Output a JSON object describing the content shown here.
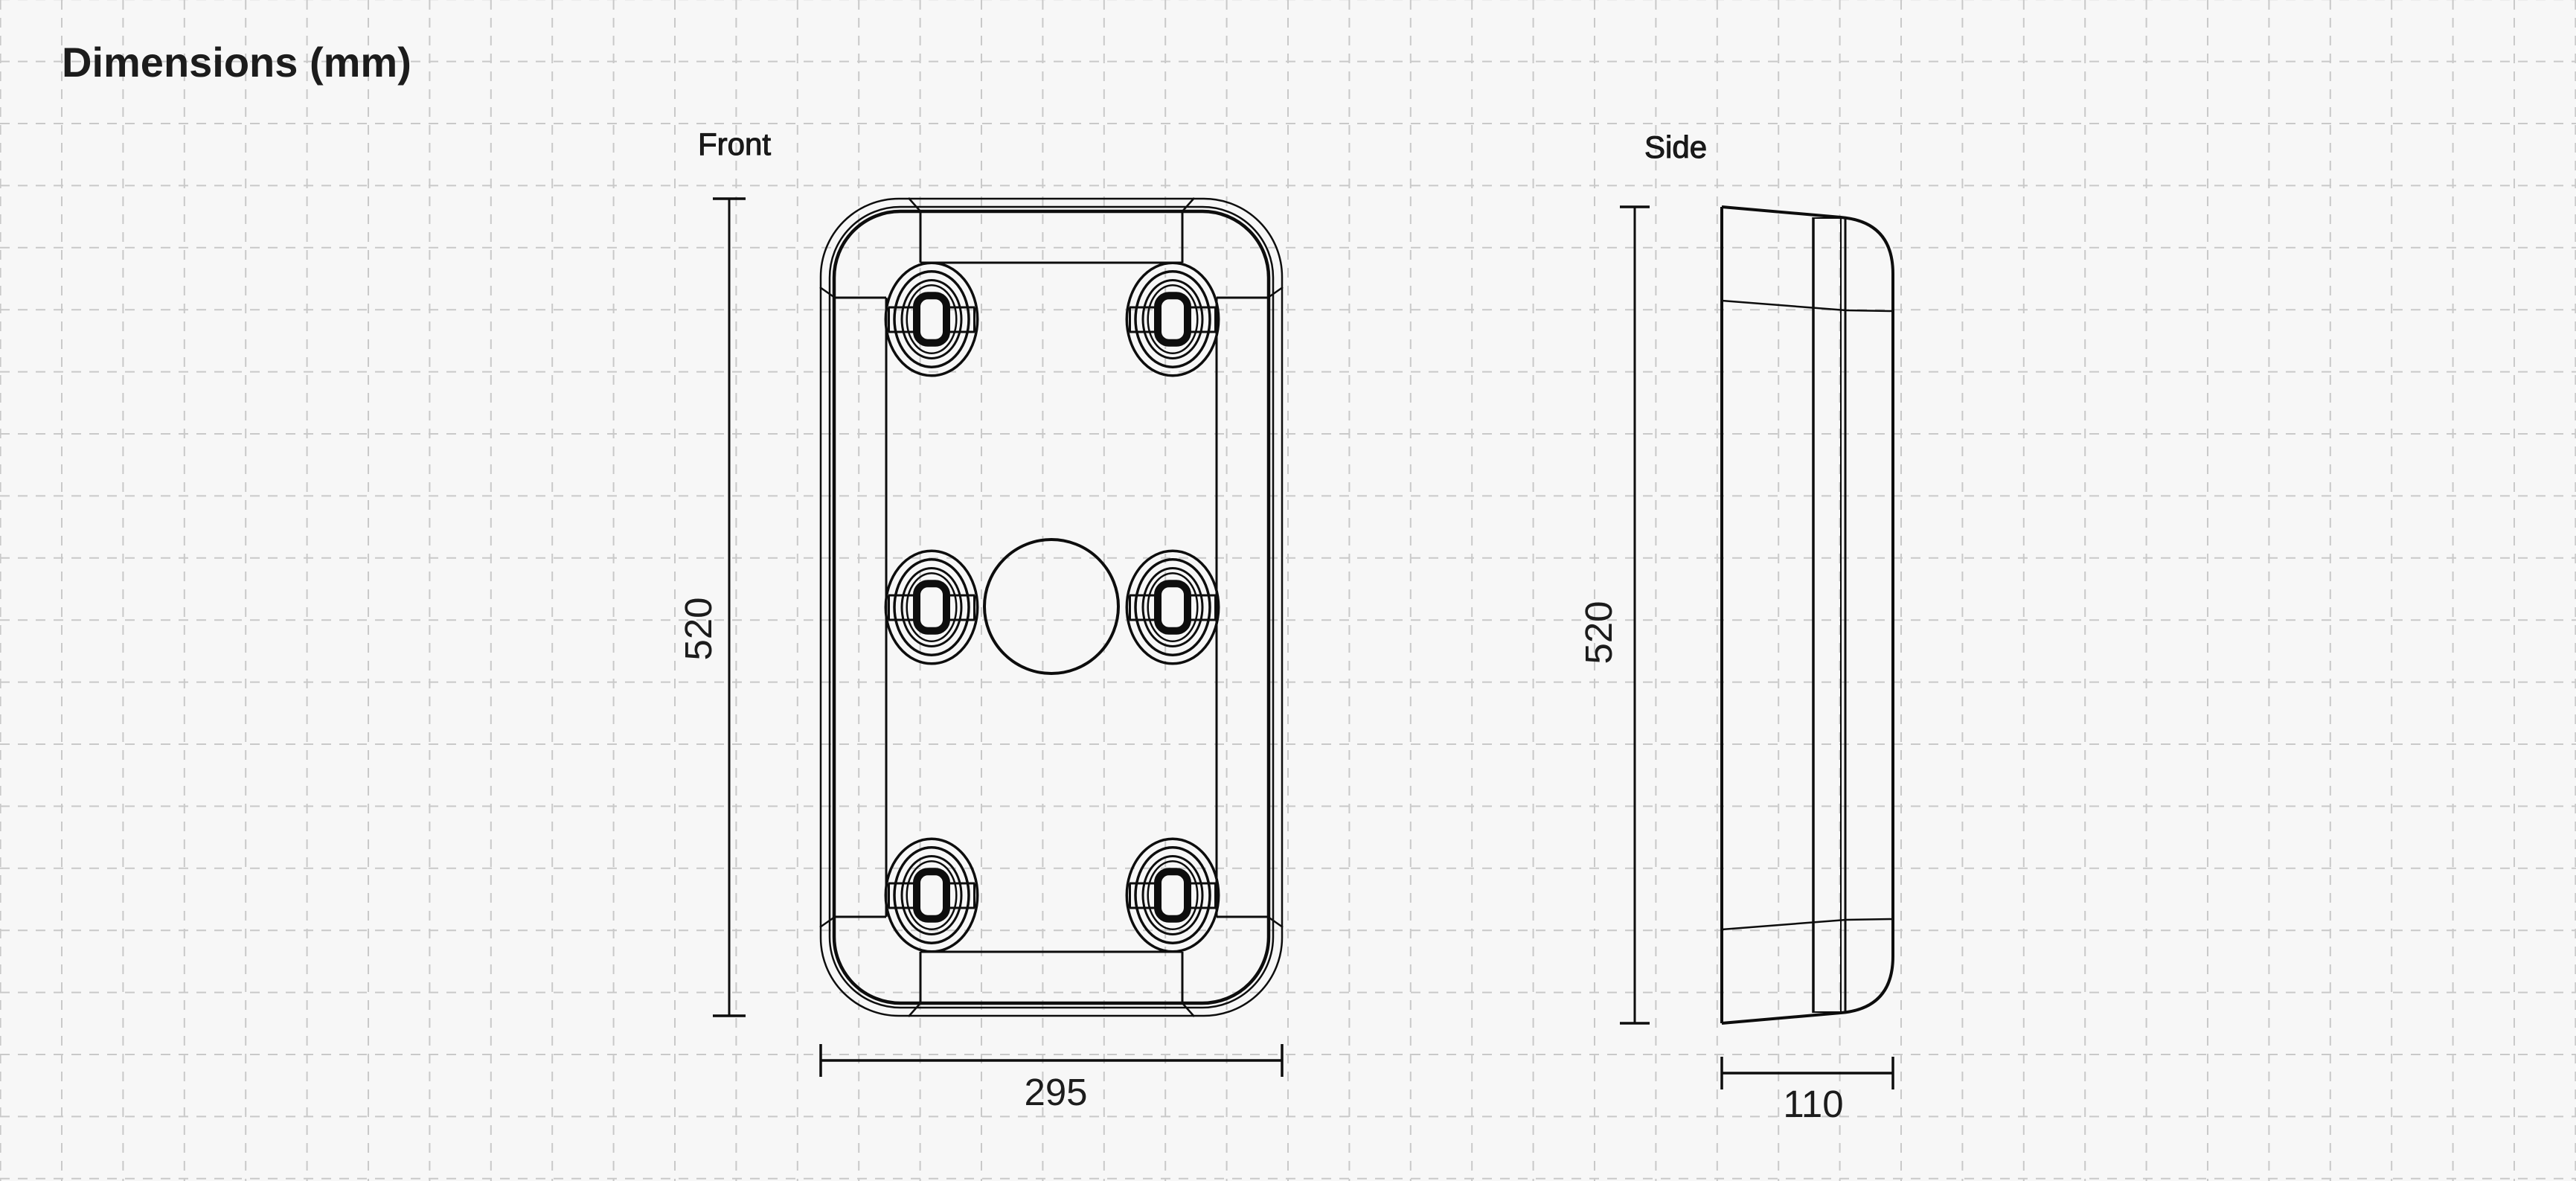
{
  "title": {
    "text": "Dimensions (mm)"
  },
  "canvas": {
    "background": "#f7f7f7",
    "ink": "#0d0d0d",
    "label_color": "#1c1c1c"
  },
  "grid": {
    "color": "#c9c9c9",
    "spacing_x": 82.4,
    "spacing_y": 83.4,
    "offset_x": 0.6,
    "offset_y": -0.8,
    "dash": "13 11",
    "stroke_width": 2
  },
  "front_view": {
    "label": "Front",
    "height_label": "520",
    "width_label": "295",
    "height_mm": 520,
    "width_mm": 295
  },
  "side_view": {
    "label": "Side",
    "height_label": "520",
    "depth_label": "110",
    "height_mm": 520,
    "depth_mm": 110
  },
  "units": "mm"
}
